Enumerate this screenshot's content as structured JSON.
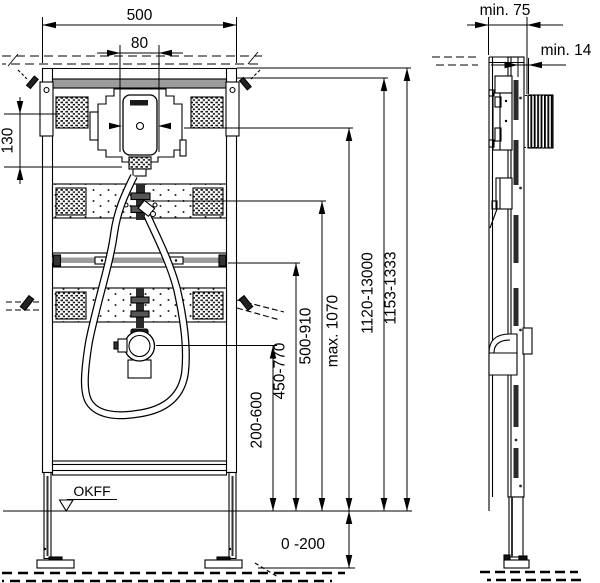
{
  "drawing": {
    "type": "installation-frame-technical-drawing",
    "front_view": {
      "dim_frame_width": "500",
      "dim_flush_unit_width": "80",
      "dim_top_bracket_offset": "130",
      "dim_foot_adjustment": "0 -200",
      "floor_reference_label": "OKFF",
      "vertical_dimensions": [
        {
          "label": "200-600"
        },
        {
          "label": "450-770"
        },
        {
          "label": "500-910"
        },
        {
          "label": "max. 1070"
        },
        {
          "label": "1120-13000"
        },
        {
          "label": "1153-1333"
        }
      ]
    },
    "side_view": {
      "dim_min_installation_depth": "min. 75",
      "dim_min_front_clearance": "min. 14"
    }
  }
}
